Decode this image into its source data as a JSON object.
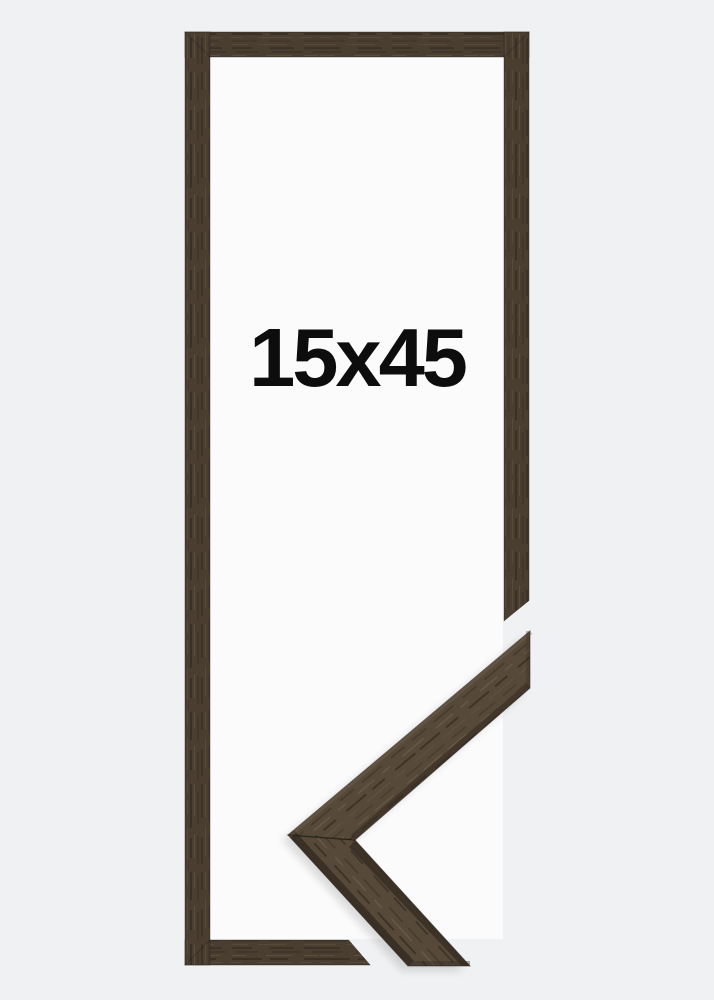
{
  "label": {
    "text": "15x45"
  },
  "colors": {
    "background": "#f0f1f2",
    "opening": "#fbfbfc",
    "frame_wood": "#4a3e31",
    "sample_wood": "#564939",
    "edge_dark": "#352c22",
    "label_text": "#0d0d0d"
  }
}
